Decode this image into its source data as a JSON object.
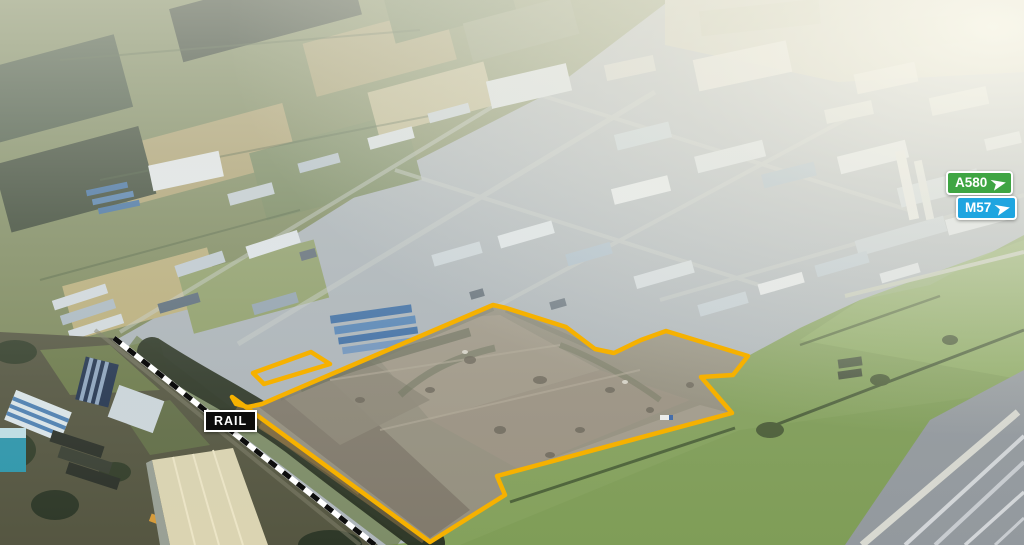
{
  "annotations": {
    "rail_label": "RAIL",
    "road_signs": [
      {
        "label": "A580",
        "color": "#3FA543",
        "icon": "navigation-arrow-icon"
      },
      {
        "label": "M57",
        "color": "#1FA5E0",
        "icon": "navigation-arrow-icon"
      }
    ],
    "boundary_color": "#F6B100",
    "site_boundary_main_points": "493,305 506,308 566,327 595,349 614,353 641,340 666,331 748,356 733,375 701,377 732,413 497,476 505,495 430,542 232,397 236,404 248,407 262,404 278,397",
    "site_boundary_secondary_points": "311,352 330,364 264,384 253,373",
    "rail_line_points": "114,338 375,545"
  }
}
